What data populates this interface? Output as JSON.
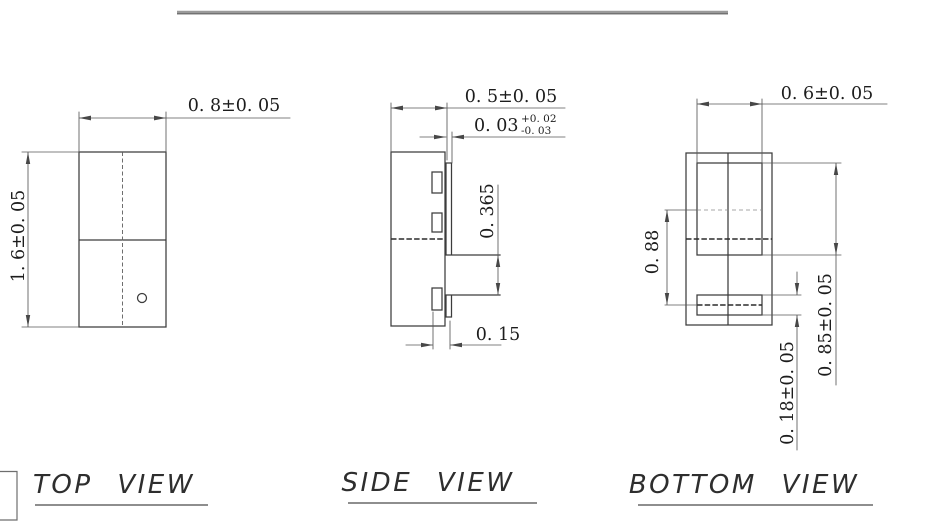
{
  "page": {
    "background": "#ffffff",
    "line_color": "#3c3c3c",
    "text_color": "#1c1c1c"
  },
  "views": {
    "top": {
      "label": "TOP VIEW",
      "width_dim": "0. 8±0. 05",
      "height_dim": "1. 6±0. 05"
    },
    "side": {
      "label": "SIDE VIEW",
      "width_dim": "0. 5±0. 05",
      "lead_thickness_dim": "0. 03",
      "lead_thickness_tol_plus": "+0. 02",
      "lead_thickness_tol_minus": "-0. 03",
      "lead_gap_dim": "0. 365",
      "foot_length_dim": "0. 15"
    },
    "bottom": {
      "label": "BOTTOM VIEW",
      "pad_width_dim": "0. 6±0. 05",
      "pad_pitch_dim": "0. 88",
      "pad_length_dim": "0. 85±0. 05",
      "end_pad_length_dim": "0. 18±0. 05"
    }
  }
}
